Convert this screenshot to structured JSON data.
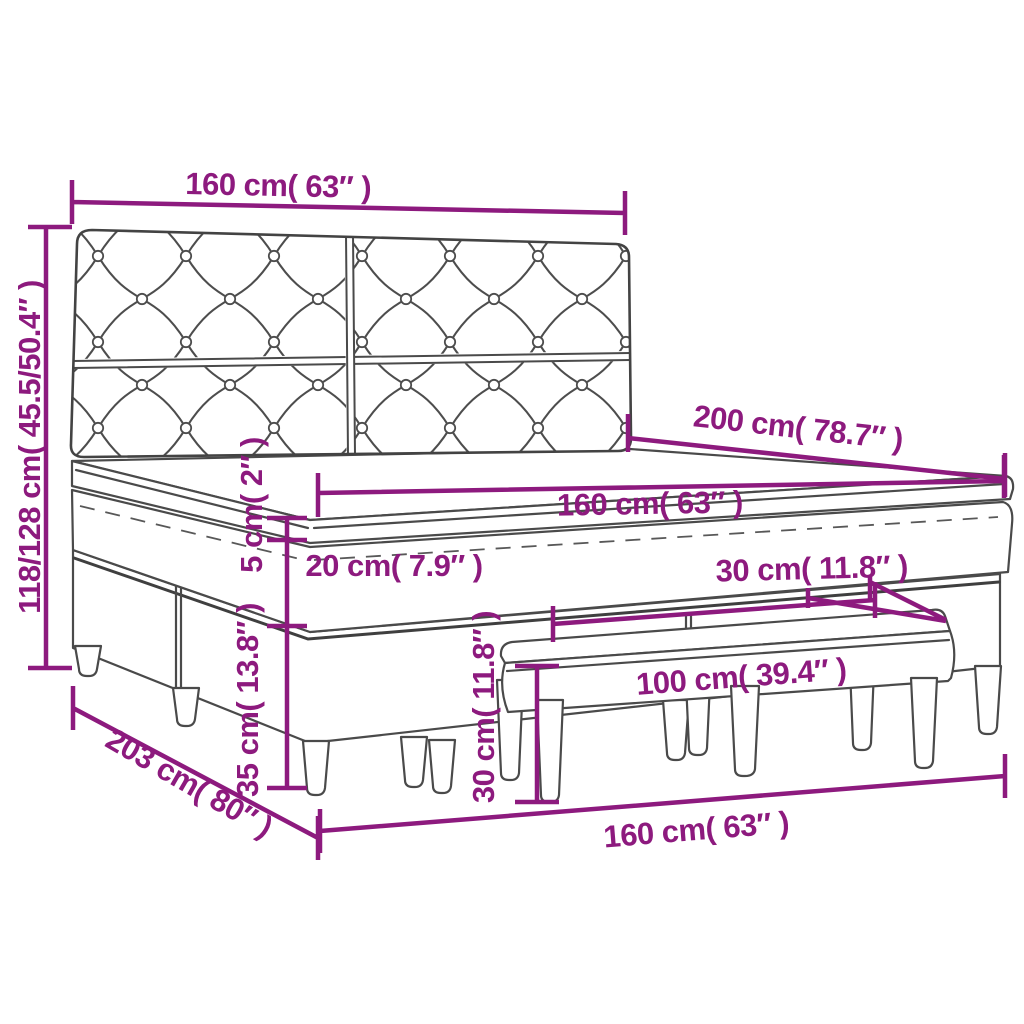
{
  "diagram": {
    "type": "product-dimension-diagram",
    "subject": "box spring bed with tufted headboard and bench",
    "colors": {
      "dimension_lines": "#8d1a7e",
      "drawing_outline": "#4a4a4a",
      "background": "#ffffff"
    },
    "labels": {
      "headboard_width": "160 cm( 63″ )",
      "headboard_height": "118/128 cm( 45.5/50.4″ )",
      "bed_length": "200 cm( 78.7″ )",
      "mattress_width": "160 cm( 63″ )",
      "topper_thickness": "5 cm( 2″ )",
      "mattress_thickness": "20 cm( 7.9″ )",
      "base_leg_height": "35 cm( 13.8″ )",
      "frame_length": "203 cm( 80″ )",
      "frame_width": "160 cm( 63″ )",
      "bench_length": "100 cm( 39.4″ )",
      "bench_height": "30 cm( 11.8″ )",
      "bench_depth": "30 cm( 11.8″ )"
    }
  }
}
